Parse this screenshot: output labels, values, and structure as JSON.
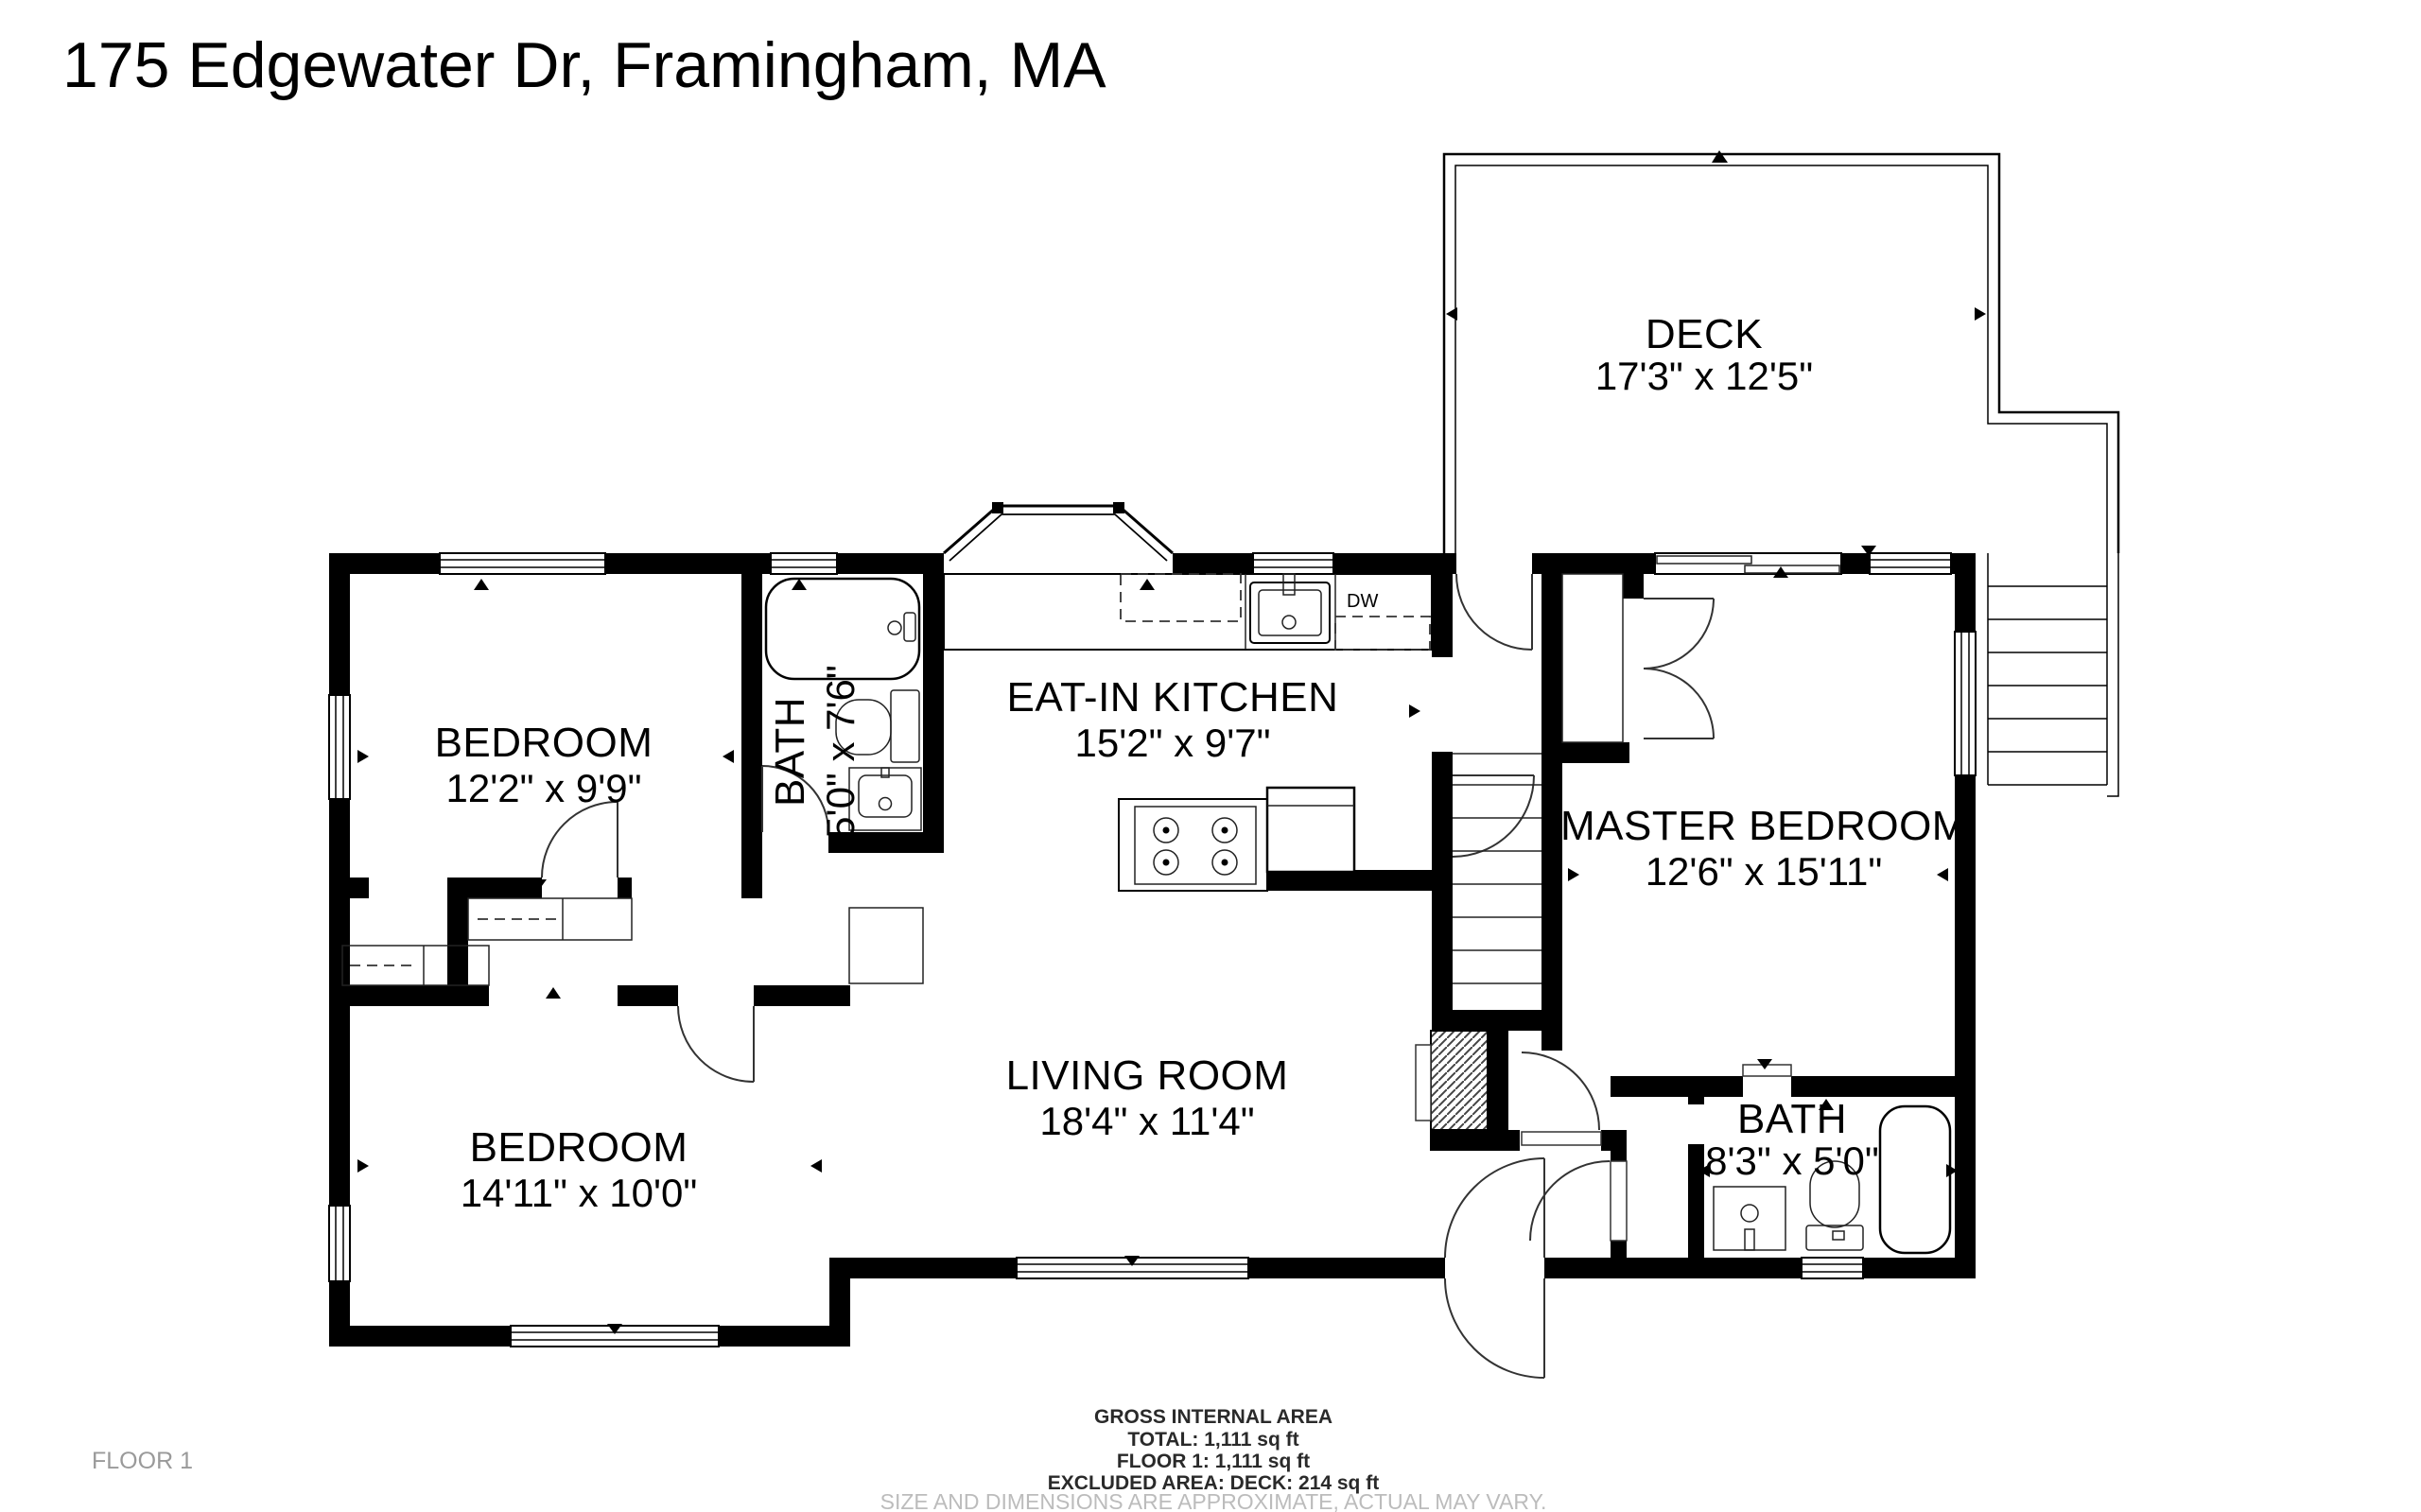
{
  "title": "175 Edgewater Dr, Framingham, MA",
  "floor_tag": "FLOOR 1",
  "rooms": {
    "deck": {
      "name": "DECK",
      "dims": "17'3\" x 12'5\""
    },
    "bedroom1": {
      "name": "BEDROOM",
      "dims": "12'2\" x 9'9\""
    },
    "bath1": {
      "name": "BATH",
      "dims": "5'0\" x 7'6\""
    },
    "kitchen": {
      "name": "EAT-IN KITCHEN",
      "dims": "15'2\" x 9'7\""
    },
    "master": {
      "name": "MASTER BEDROOM",
      "dims": "12'6\" x 15'11\""
    },
    "bedroom2": {
      "name": "BEDROOM",
      "dims": "14'11\" x 10'0\""
    },
    "living": {
      "name": "LIVING ROOM",
      "dims": "18'4\" x 11'4\""
    },
    "bath2": {
      "name": "BATH",
      "dims": "8'3\" x 5'0\""
    }
  },
  "fixtures": {
    "dishwasher": "DW"
  },
  "footer": {
    "line1": "GROSS INTERNAL AREA",
    "line2": "TOTAL: 1,111 sq ft",
    "line3": "FLOOR 1: 1,111 sq ft",
    "line4": "EXCLUDED AREA: DECK: 214 sq ft",
    "disclaimer": "SIZE AND DIMENSIONS ARE APPROXIMATE, ACTUAL MAY VARY."
  },
  "colors": {
    "wall": "#000000",
    "background": "#ffffff",
    "muted_text": "#9a9a9a"
  }
}
